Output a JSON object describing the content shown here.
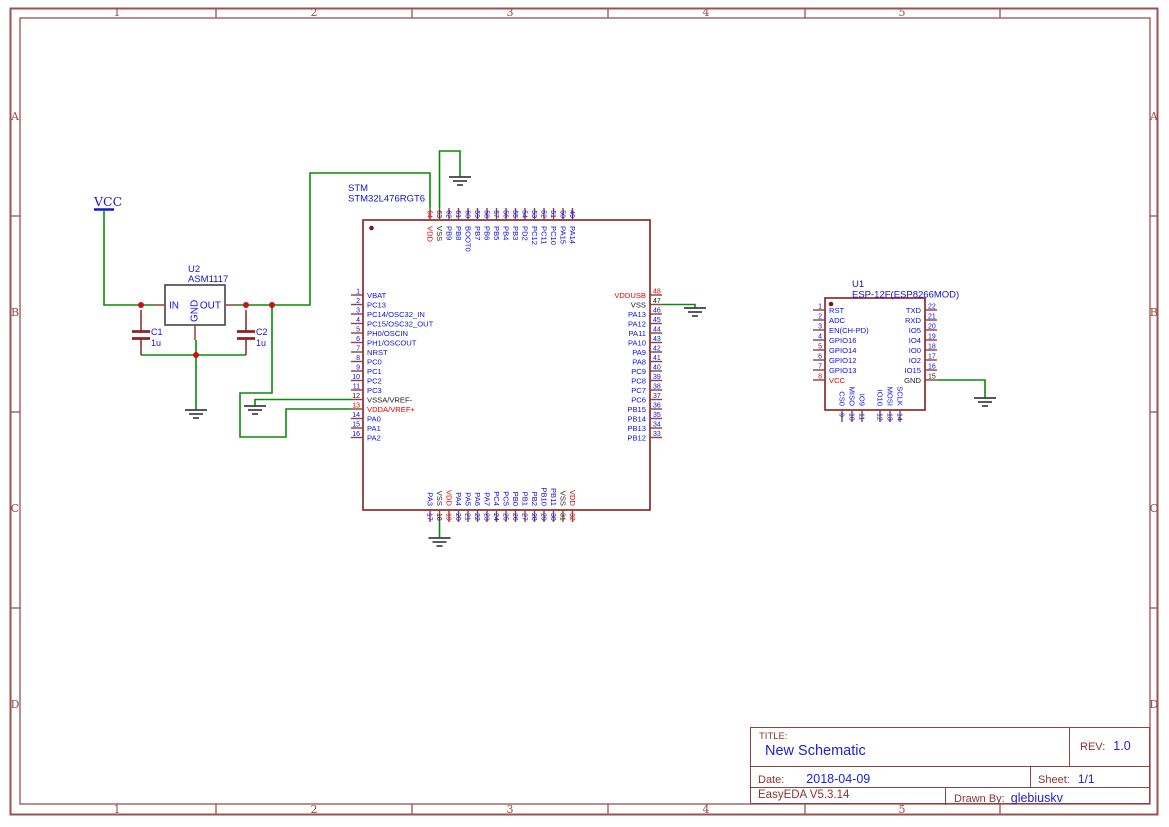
{
  "frame": {
    "column_labels": [
      "1",
      "2",
      "3",
      "4",
      "5"
    ],
    "row_labels": [
      "A",
      "B",
      "C",
      "D"
    ],
    "column_centers": [
      117,
      314,
      510,
      706,
      902
    ],
    "column_dividers": [
      216,
      412,
      608,
      805,
      1000
    ],
    "row_centers": [
      116,
      312,
      508,
      704
    ],
    "row_dividers": [
      216,
      412,
      608
    ]
  },
  "title_block": {
    "title_label": "TITLE:",
    "title": "New Schematic",
    "rev_label": "REV:",
    "rev": "1.0",
    "date_label": "Date:",
    "date": "2018-04-09",
    "sheet_label": "Sheet:",
    "sheet": "1/1",
    "software": "EasyEDA V5.3.14",
    "drawn_by_label": "Drawn By:",
    "drawn_by": "glebiuskv"
  },
  "colors": {
    "frame": "#9a5252",
    "frame_text": "#9a4a4a",
    "wire": "#0a8a0a",
    "junction": "#cc1111",
    "ground": "#3f3f3f",
    "chip_border": "#8b2b2b",
    "reg_border": "#4f4f4f",
    "pin_stub": "#8f4040",
    "cap": "#8b2222",
    "pin_io": "#0f0fe6",
    "pin_power": "#e80000",
    "pin_ground": "#1a1a1a",
    "label_blue": "#1414cc",
    "vcc_blue": "#1a1acd"
  },
  "power_flags": [
    {
      "name": "VCC",
      "x": 104,
      "y": 206
    }
  ],
  "capacitors": [
    {
      "ref": "C1",
      "value": "1u",
      "x": 141,
      "top_y": 305,
      "bot_y": 355
    },
    {
      "ref": "C2",
      "value": "1u",
      "x": 246,
      "top_y": 305,
      "bot_y": 355
    }
  ],
  "regulator": {
    "designator": "U2",
    "part": "ASM1117",
    "x1": 165,
    "y1": 285,
    "x2": 225,
    "y2": 325,
    "pin_in": "IN",
    "pin_out": "OUT",
    "pin_gnd": "GND",
    "label_x": 188,
    "label_y": 272
  },
  "chips": [
    {
      "designator": "STM",
      "part": "STM32L476RGT6",
      "x1": 363,
      "y1": 220,
      "x2": 650,
      "y2": 510,
      "label_x": 348,
      "label_y": 191,
      "pin1_dot": [
        371.5,
        228
      ],
      "left": {
        "y0": 295,
        "pitch": 9.5,
        "pins": [
          {
            "num": "1",
            "name": "VBAT"
          },
          {
            "num": "2",
            "name": "PC13"
          },
          {
            "num": "3",
            "name": "PC14/OSC32_IN"
          },
          {
            "num": "4",
            "name": "PC15/OSC32_OUT"
          },
          {
            "num": "5",
            "name": "PH0/OSCIN"
          },
          {
            "num": "6",
            "name": "PH1/OSCOUT"
          },
          {
            "num": "7",
            "name": "NRST"
          },
          {
            "num": "8",
            "name": "PC0"
          },
          {
            "num": "9",
            "name": "PC1"
          },
          {
            "num": "10",
            "name": "PC2"
          },
          {
            "num": "11",
            "name": "PC3"
          },
          {
            "num": "12",
            "name": "VSSA/VREF-",
            "type": "ground"
          },
          {
            "num": "13",
            "name": "VDDA/VREF+",
            "type": "power"
          },
          {
            "num": "14",
            "name": "PA0"
          },
          {
            "num": "15",
            "name": "PA1"
          },
          {
            "num": "16",
            "name": "PA2"
          }
        ]
      },
      "right": {
        "y0": 295,
        "pitch": 9.5,
        "pins": [
          {
            "num": "48",
            "name": "VDDUSB",
            "type": "power"
          },
          {
            "num": "47",
            "name": "VSS",
            "type": "ground"
          },
          {
            "num": "46",
            "name": "PA13"
          },
          {
            "num": "45",
            "name": "PA12"
          },
          {
            "num": "44",
            "name": "PA11"
          },
          {
            "num": "43",
            "name": "PA10"
          },
          {
            "num": "42",
            "name": "PA9"
          },
          {
            "num": "41",
            "name": "PA8"
          },
          {
            "num": "40",
            "name": "PC9"
          },
          {
            "num": "39",
            "name": "PC8"
          },
          {
            "num": "38",
            "name": "PC7"
          },
          {
            "num": "37",
            "name": "PC6"
          },
          {
            "num": "36",
            "name": "PB15"
          },
          {
            "num": "35",
            "name": "PB14"
          },
          {
            "num": "34",
            "name": "PB13"
          },
          {
            "num": "33",
            "name": "PB12"
          }
        ]
      },
      "top": {
        "x0": 430,
        "pitch": 9.5,
        "pins": [
          {
            "num": "64",
            "name": "VDD",
            "type": "power"
          },
          {
            "num": "63",
            "name": "VSS",
            "type": "ground"
          },
          {
            "num": "62",
            "name": "PB9"
          },
          {
            "num": "61",
            "name": "PB8"
          },
          {
            "num": "60",
            "name": "BOOT0"
          },
          {
            "num": "59",
            "name": "PB7"
          },
          {
            "num": "58",
            "name": "PB6"
          },
          {
            "num": "57",
            "name": "PB5"
          },
          {
            "num": "56",
            "name": "PB4"
          },
          {
            "num": "55",
            "name": "PB3"
          },
          {
            "num": "54",
            "name": "PD2"
          },
          {
            "num": "53",
            "name": "PC12"
          },
          {
            "num": "52",
            "name": "PC11"
          },
          {
            "num": "51",
            "name": "PC10"
          },
          {
            "num": "50",
            "name": "PA15"
          },
          {
            "num": "49",
            "name": "PA14"
          }
        ]
      },
      "bottom": {
        "x0": 430,
        "pitch": 9.5,
        "pins": [
          {
            "num": "17",
            "name": "PA3"
          },
          {
            "num": "18",
            "name": "VSS",
            "type": "ground"
          },
          {
            "num": "19",
            "name": "VDD",
            "type": "power"
          },
          {
            "num": "20",
            "name": "PA4"
          },
          {
            "num": "21",
            "name": "PA5"
          },
          {
            "num": "22",
            "name": "PA6"
          },
          {
            "num": "23",
            "name": "PA7"
          },
          {
            "num": "24",
            "name": "PC4"
          },
          {
            "num": "25",
            "name": "PC5"
          },
          {
            "num": "26",
            "name": "PB0"
          },
          {
            "num": "27",
            "name": "PB1"
          },
          {
            "num": "28",
            "name": "PB2"
          },
          {
            "num": "29",
            "name": "PB10"
          },
          {
            "num": "30",
            "name": "PB11"
          },
          {
            "num": "31",
            "name": "VSS",
            "type": "ground"
          },
          {
            "num": "32",
            "name": "VDD",
            "type": "power"
          }
        ]
      }
    },
    {
      "designator": "U1",
      "part": "ESP-12F(ESP8266MOD)",
      "x1": 825,
      "y1": 298,
      "x2": 925,
      "y2": 410,
      "label_x": 852,
      "label_y": 287,
      "pin1_dot": [
        831,
        304
      ],
      "left": {
        "y0": 310,
        "pitch": 10,
        "pins": [
          {
            "num": "1",
            "name": "RST"
          },
          {
            "num": "2",
            "name": "ADC"
          },
          {
            "num": "3",
            "name": "EN(CH-PD)"
          },
          {
            "num": "4",
            "name": "GPIO16"
          },
          {
            "num": "5",
            "name": "GPIO14"
          },
          {
            "num": "6",
            "name": "GPIO12"
          },
          {
            "num": "7",
            "name": "GPIO13"
          },
          {
            "num": "8",
            "name": "VCC",
            "type": "power"
          }
        ]
      },
      "right": {
        "y0": 310,
        "pitch": 10,
        "pins": [
          {
            "num": "22",
            "name": "TXD"
          },
          {
            "num": "21",
            "name": "RXD"
          },
          {
            "num": "20",
            "name": "IO5"
          },
          {
            "num": "19",
            "name": "IO4"
          },
          {
            "num": "18",
            "name": "IO0"
          },
          {
            "num": "17",
            "name": "IO2"
          },
          {
            "num": "16",
            "name": "IO15"
          },
          {
            "num": "15",
            "name": "GND",
            "type": "ground"
          }
        ]
      },
      "bottom": {
        "xs": [
          842,
          852,
          862,
          880,
          890,
          900
        ],
        "pins": [
          {
            "num": "9",
            "name": "CS0"
          },
          {
            "num": "10",
            "name": "MISO"
          },
          {
            "num": "11",
            "name": "IO9"
          },
          {
            "num": "12",
            "name": "IO10"
          },
          {
            "num": "13",
            "name": "MOSI"
          },
          {
            "num": "14",
            "name": "SCLK"
          }
        ]
      }
    }
  ],
  "wires": [
    [
      [
        104,
        211
      ],
      [
        104,
        305
      ],
      [
        153,
        305
      ]
    ],
    [
      [
        237,
        305
      ],
      [
        310,
        305
      ],
      [
        310,
        173
      ],
      [
        430,
        173
      ],
      [
        430,
        208
      ]
    ],
    [
      [
        439.5,
        208
      ],
      [
        439.5,
        151
      ],
      [
        460,
        151
      ],
      [
        460,
        177
      ]
    ],
    [
      [
        272,
        305
      ],
      [
        272,
        393
      ],
      [
        240,
        393
      ],
      [
        240,
        437
      ],
      [
        286,
        437
      ],
      [
        286,
        409
      ],
      [
        351,
        409
      ]
    ],
    [
      [
        255,
        406
      ],
      [
        255,
        399.5
      ],
      [
        351,
        399.5
      ]
    ],
    [
      [
        141,
        355
      ],
      [
        246,
        355
      ]
    ],
    [
      [
        196,
        340
      ],
      [
        196,
        410
      ]
    ],
    [
      [
        662,
        304.5
      ],
      [
        695,
        304.5
      ],
      [
        695,
        308
      ]
    ],
    [
      [
        439.5,
        522
      ],
      [
        439.5,
        538
      ]
    ],
    [
      [
        937,
        380
      ],
      [
        985,
        380
      ],
      [
        985,
        398
      ]
    ]
  ],
  "junctions": [
    [
      141,
      305
    ],
    [
      246,
      305
    ],
    [
      272,
      305
    ],
    [
      196,
      355
    ]
  ],
  "grounds": [
    [
      460,
      177
    ],
    [
      196,
      410
    ],
    [
      255,
      406
    ],
    [
      439.5,
      538
    ],
    [
      695,
      308
    ],
    [
      985,
      398
    ]
  ]
}
